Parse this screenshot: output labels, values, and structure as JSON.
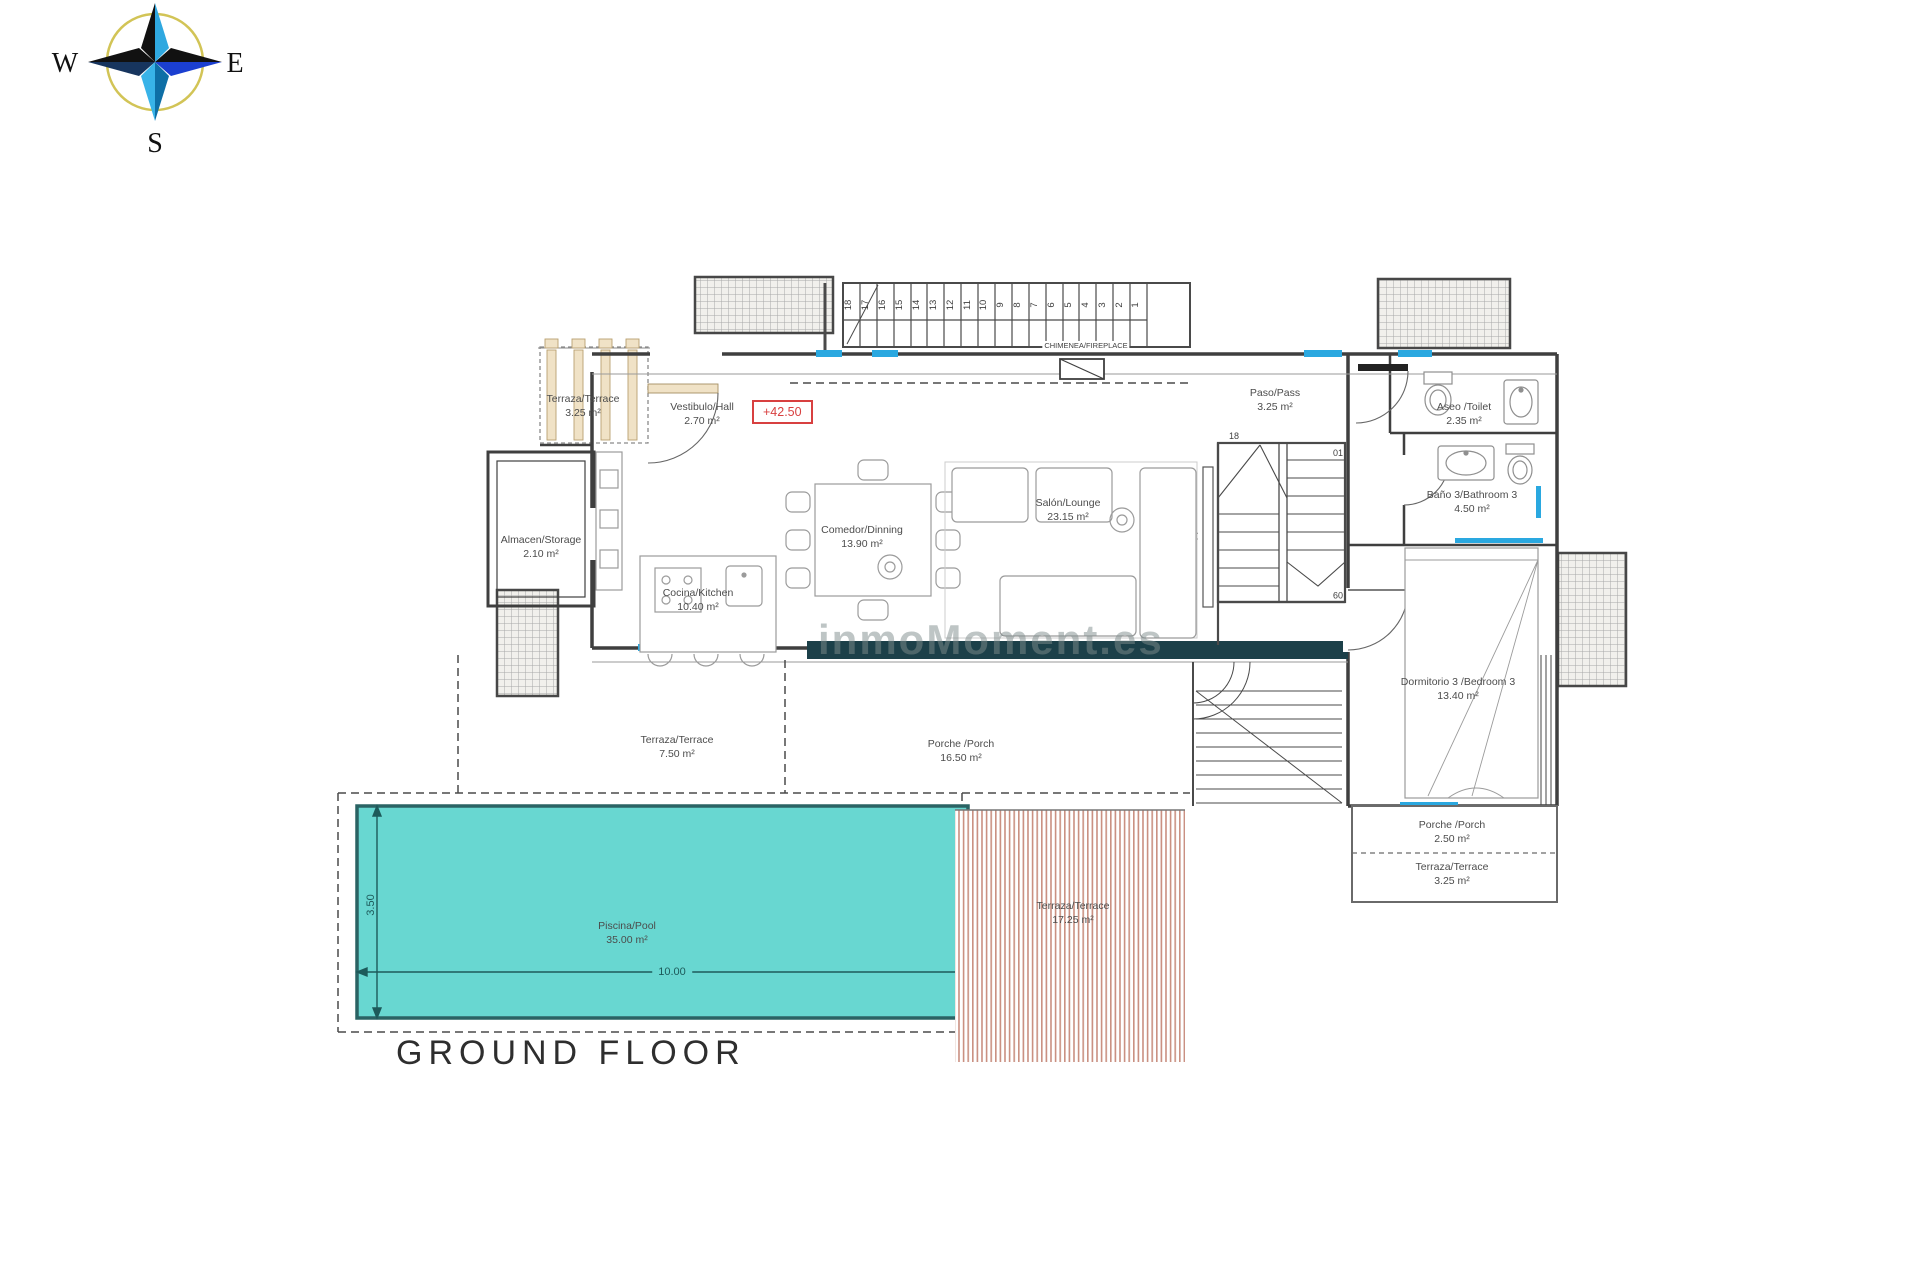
{
  "title": "GROUND FLOOR",
  "watermark": "inmoMoment.es",
  "level_marker": "+42.50",
  "compass": {
    "w": "W",
    "e": "E",
    "s": "S"
  },
  "rooms": {
    "terrace_nw": {
      "name": "Terraza/Terrace",
      "area": "3.25 m²"
    },
    "hall": {
      "name": "Vestibulo/Hall",
      "area": "2.70 m²"
    },
    "storage": {
      "name": "Almacen/Storage",
      "area": "2.10 m²"
    },
    "dining": {
      "name": "Comedor/Dinning",
      "area": "13.90 m²"
    },
    "lounge": {
      "name": "Salón/Lounge",
      "area": "23.15 m²"
    },
    "kitchen": {
      "name": "Cocina/Kitchen",
      "area": "10.40 m²"
    },
    "pass": {
      "name": "Paso/Pass",
      "area": "3.25 m²"
    },
    "toilet": {
      "name": "Aseo /Toilet",
      "area": "2.35 m²"
    },
    "bathroom3": {
      "name": "Baño 3/Bathroom 3",
      "area": "4.50 m²"
    },
    "bedroom3": {
      "name": "Dormitorio 3 /Bedroom 3",
      "area": "13.40 m²"
    },
    "terrace_s": {
      "name": "Terraza/Terrace",
      "area": "7.50 m²"
    },
    "porch": {
      "name": "Porche /Porch",
      "area": "16.50 m²"
    },
    "pool": {
      "name": "Piscina/Pool",
      "area": "35.00 m²"
    },
    "terrace_se": {
      "name": "Terraza/Terrace",
      "area": "17.25 m²"
    },
    "porch_e": {
      "name": "Porche /Porch",
      "area": "2.50 m²"
    },
    "terrace_e": {
      "name": "Terraza/Terrace",
      "area": "3.25 m²"
    }
  },
  "annotations": {
    "fireplace": "CHIMENEA/FIREPLACE",
    "tv": "TV"
  },
  "dimensions": {
    "pool_length": "10.00",
    "pool_width": "3.50"
  },
  "stairs": {
    "top": "18",
    "first": "01",
    "mid": "09",
    "numbers": [
      "18",
      "17",
      "16",
      "15",
      "14",
      "13",
      "12",
      "11",
      "10",
      "9",
      "8",
      "7",
      "6",
      "5",
      "4",
      "3",
      "2",
      "1"
    ]
  },
  "colors": {
    "wall": "#3f3f3f",
    "window": "#2aa8e0",
    "glazing_band": "#1c4049",
    "pool_fill": "#68d7d1",
    "pool_edge": "#2a6364",
    "stripe": "#c98f80",
    "level_red": "#d84040",
    "pergola_wood": "#f0e2c6"
  }
}
